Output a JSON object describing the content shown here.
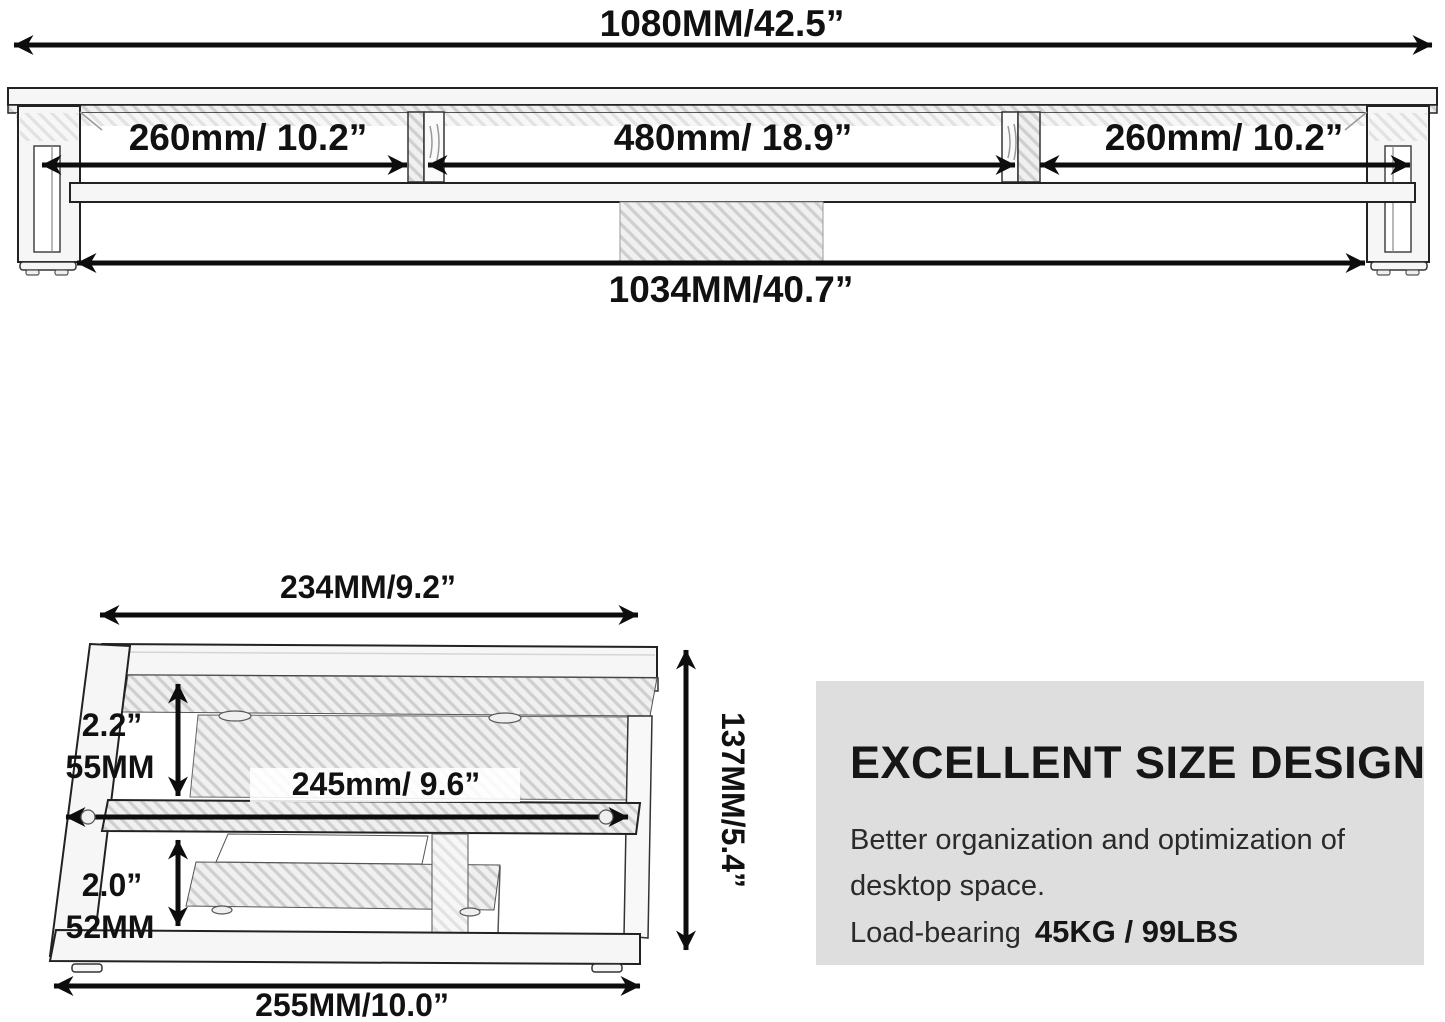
{
  "colors": {
    "panel_bg": "#dedede",
    "line_color": "#0d0d0d",
    "text_color": "#111111",
    "wood_fill": "#f6f6f6"
  },
  "front_view": {
    "total_width_label": "1080MM/42.5”",
    "left_section_label": "260mm/ 10.2”",
    "middle_section_label": "480mm/ 18.9”",
    "right_section_label": "260mm/ 10.2”",
    "base_width_label": "1034MM/40.7”"
  },
  "side_view": {
    "top_width_label": "234MM/9.2”",
    "upper_clearance_inch": "2.2”",
    "upper_clearance_mm": "55MM",
    "shelf_depth_label": "245mm/ 9.6”",
    "lower_clearance_inch": "2.0”",
    "lower_clearance_mm": "52MM",
    "overall_height_label": "137MM/5.4”",
    "base_depth_label": "255MM/10.0”"
  },
  "info_panel": {
    "title": "EXCELLENT SIZE DESIGN",
    "description_line1": "Better organization and optimization of",
    "description_line2": "desktop space.",
    "load_bearing_label": "Load-bearing",
    "load_bearing_value": "45KG / 99LBS"
  }
}
